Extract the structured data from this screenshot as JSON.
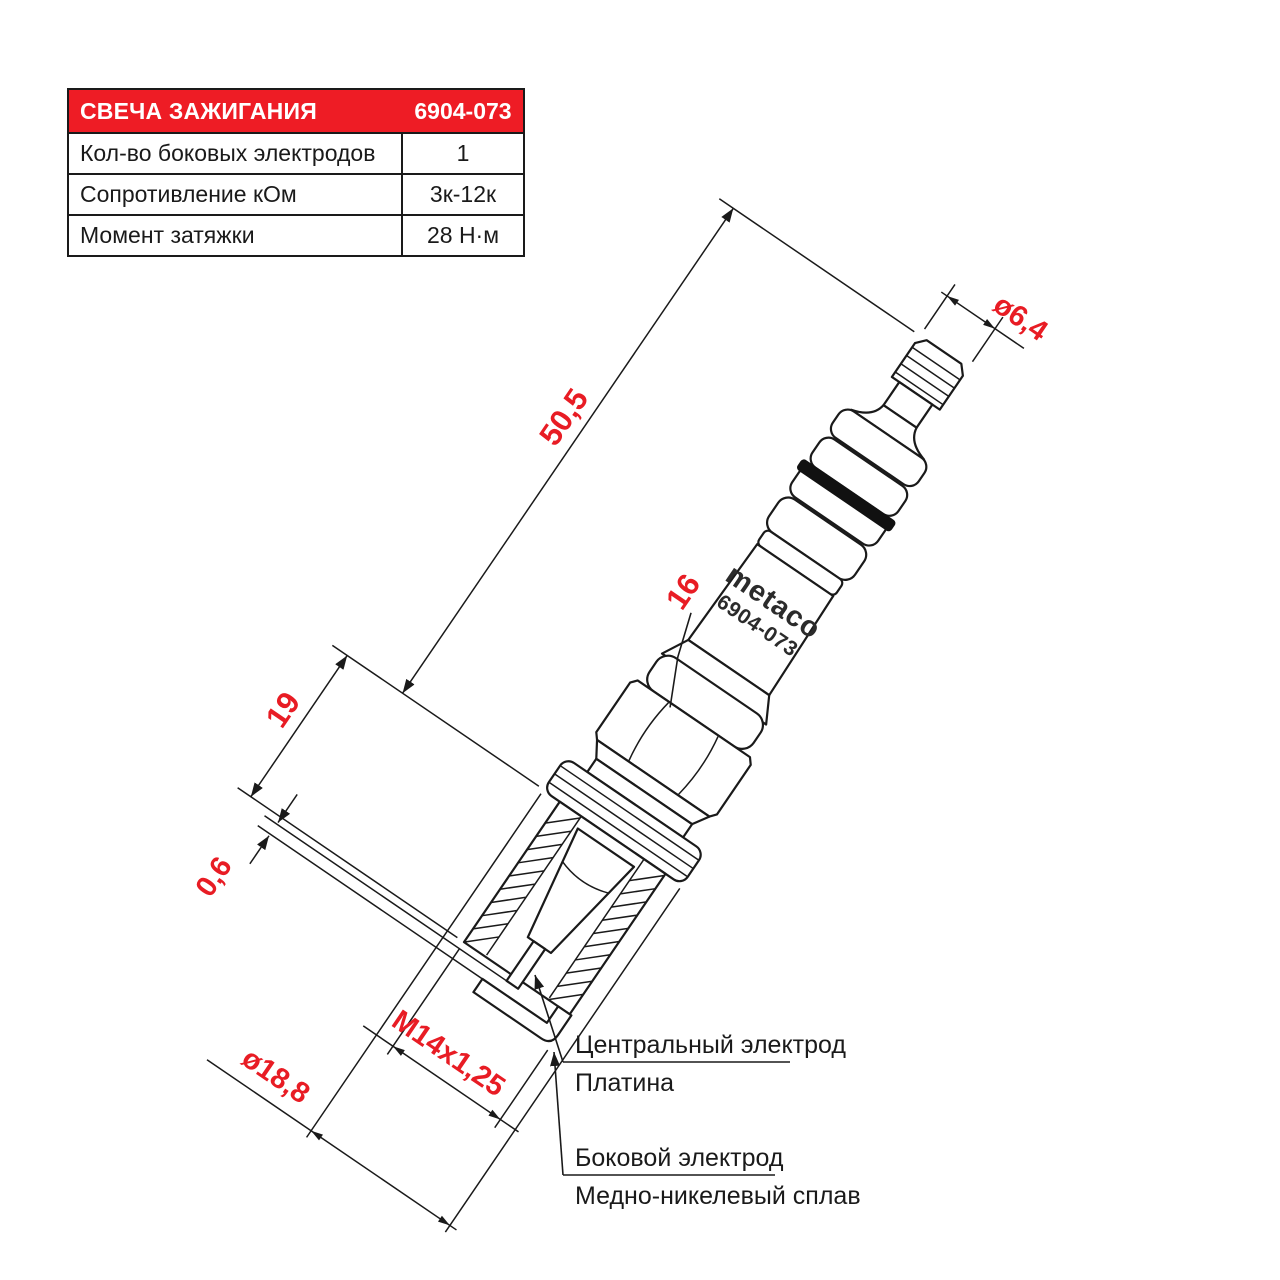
{
  "colors": {
    "accent_red": "#ee1c25",
    "dimension_red": "#e81c24",
    "line_black": "#1a1a1a",
    "brand_gray": "#2b2b2b"
  },
  "spec_table": {
    "header": {
      "title": "СВЕЧА ЗАЖИГАНИЯ",
      "part_number": "6904-073"
    },
    "rows": [
      {
        "label": "Кол-во боковых электродов",
        "value": "1"
      },
      {
        "label": "Сопротивление кОм",
        "value": "3к-12к"
      },
      {
        "label": "Момент затяжки",
        "value": "28 Н·м"
      }
    ]
  },
  "drawing": {
    "brand": "metaco",
    "model": "6904-073",
    "dimensions": {
      "overall_length": "50,5",
      "thread_length": "19",
      "hex_size": "16",
      "terminal_diameter": "ø6,4",
      "spark_gap": "0,6",
      "thread_spec": "M14x1,25",
      "shell_diameter": "ø18,8"
    },
    "callouts": {
      "central_electrode": {
        "line1": "Центральный электрод",
        "line2": "Платина"
      },
      "side_electrode": {
        "line1": "Боковой электрод",
        "line2": "Медно-никелевый сплав"
      }
    }
  }
}
